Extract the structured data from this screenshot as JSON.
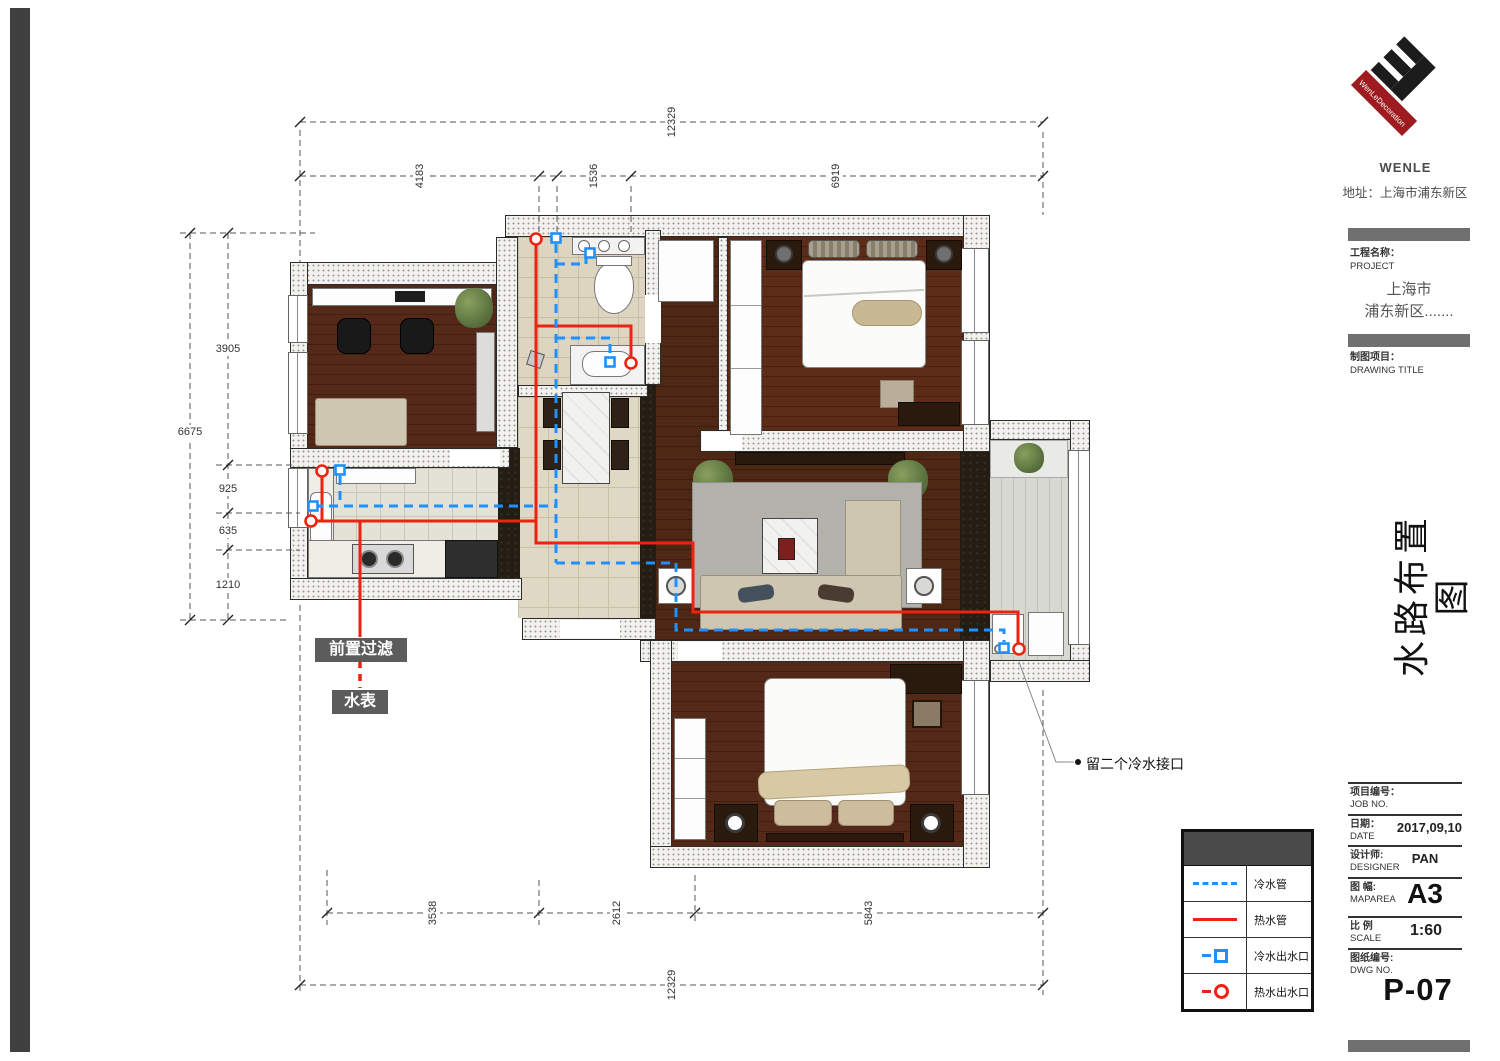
{
  "colors": {
    "cold_pipe": "#1e90ff",
    "hot_pipe": "#ee2211",
    "logo_red": "#9e1b1f",
    "panel_gray": "#707070"
  },
  "logo": {
    "diagonal_text": "WenLeDecoration",
    "brand": "WENLE",
    "address": "地址：上海市浦东新区"
  },
  "title_block": {
    "project_label_cn": "工程名称：",
    "project_label_en": "PROJECT",
    "project_line1": "上海市",
    "project_line2": "浦东新区.......",
    "drawing_label_cn": "制图项目：",
    "drawing_label_en": "DRAWING TITLE",
    "drawing_title_vertical": "水路布置图",
    "job_no_cn": "项目编号：",
    "job_no_en": "JOB NO.",
    "date_cn": "日期：",
    "date_en": "DATE",
    "date_value": "2017,09,10",
    "designer_cn": "设计师:",
    "designer_en": "DESIGNER",
    "designer_value": "PAN",
    "map_area_cn": "图 幅:",
    "map_area_en": "MAPAREA",
    "map_area_value": "A3",
    "scale_cn": "比 例",
    "scale_en": "SCALE",
    "scale_value": "1:60",
    "dwg_no_cn": "图纸编号:",
    "dwg_no_en": "DWG NO.",
    "sheet_no": "P-07"
  },
  "legend": {
    "rows": [
      {
        "symbol": "cold-water-pipe",
        "label": "冷水管"
      },
      {
        "symbol": "hot-water-pipe",
        "label": "热水管"
      },
      {
        "symbol": "cold-water-outlet",
        "label": "冷水出水口"
      },
      {
        "symbol": "hot-water-outlet",
        "label": "热水出水口"
      }
    ]
  },
  "plan": {
    "annotations": {
      "pre_filter": "前置过滤",
      "water_meter": "水表",
      "cold_note": "留二个冷水接口"
    },
    "dimensions": {
      "top": {
        "overall": "12329",
        "seg1": "4183",
        "seg2": "1536",
        "seg3": "6919"
      },
      "left": {
        "overall": "6675",
        "seg1": "3905",
        "seg2": "925",
        "seg3": "635",
        "seg4": "1210"
      },
      "bottom": {
        "overall": "12329",
        "seg1": "3538",
        "seg2": "2612",
        "seg3": "5843"
      }
    }
  }
}
